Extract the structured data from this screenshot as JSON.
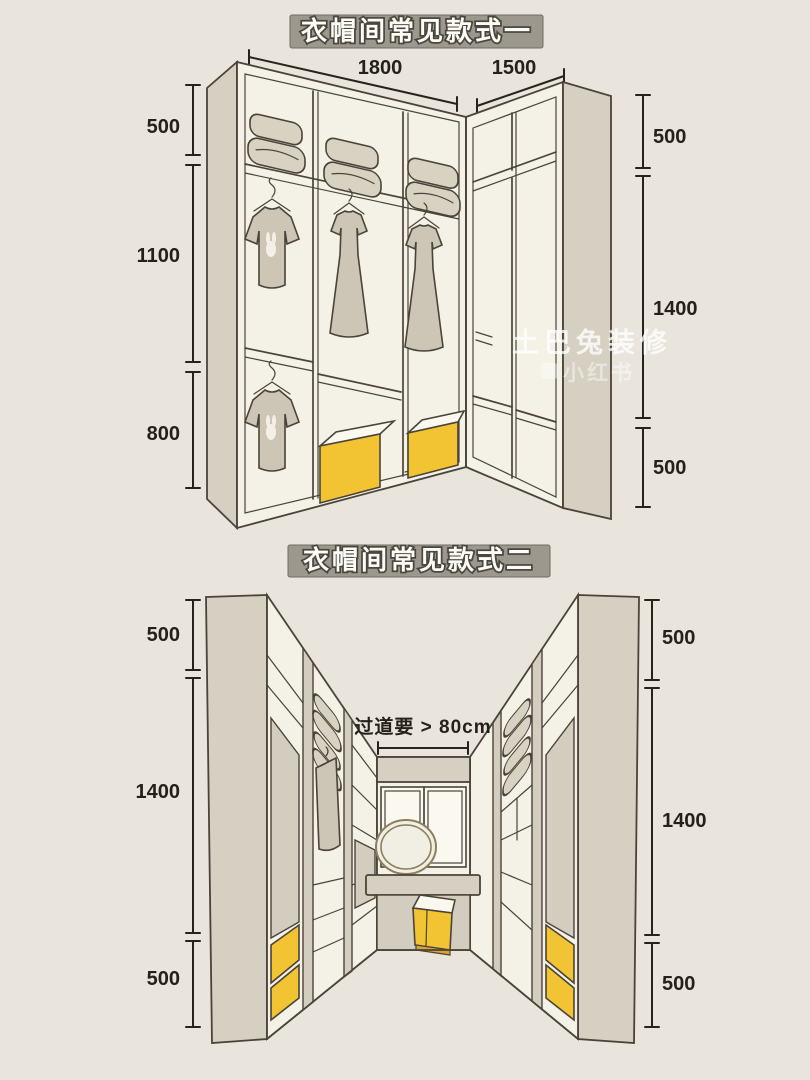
{
  "colors": {
    "background": "#e9e5dc",
    "line": "#4a4339",
    "cabinet_panel": "#d6d0c2",
    "cabinet_interior": "#f4f1e7",
    "accent_yellow": "#f2c434",
    "banner_gray": "#9c988d",
    "dimension_text": "#24211c"
  },
  "watermark": {
    "brand": "土巴兔装修",
    "platform": "小红书"
  },
  "diagram1": {
    "title": "衣帽间常见款式一",
    "top_widths": [
      "1800",
      "1500"
    ],
    "left_heights": [
      "500",
      "1100",
      "800"
    ],
    "right_heights": [
      "500",
      "1400",
      "500"
    ]
  },
  "diagram2": {
    "title": "衣帽间常见款式二",
    "aisle_note": "过道要 > 80cm",
    "left_heights": [
      "500",
      "1400",
      "500"
    ],
    "right_heights": [
      "500",
      "1400",
      "500"
    ]
  }
}
